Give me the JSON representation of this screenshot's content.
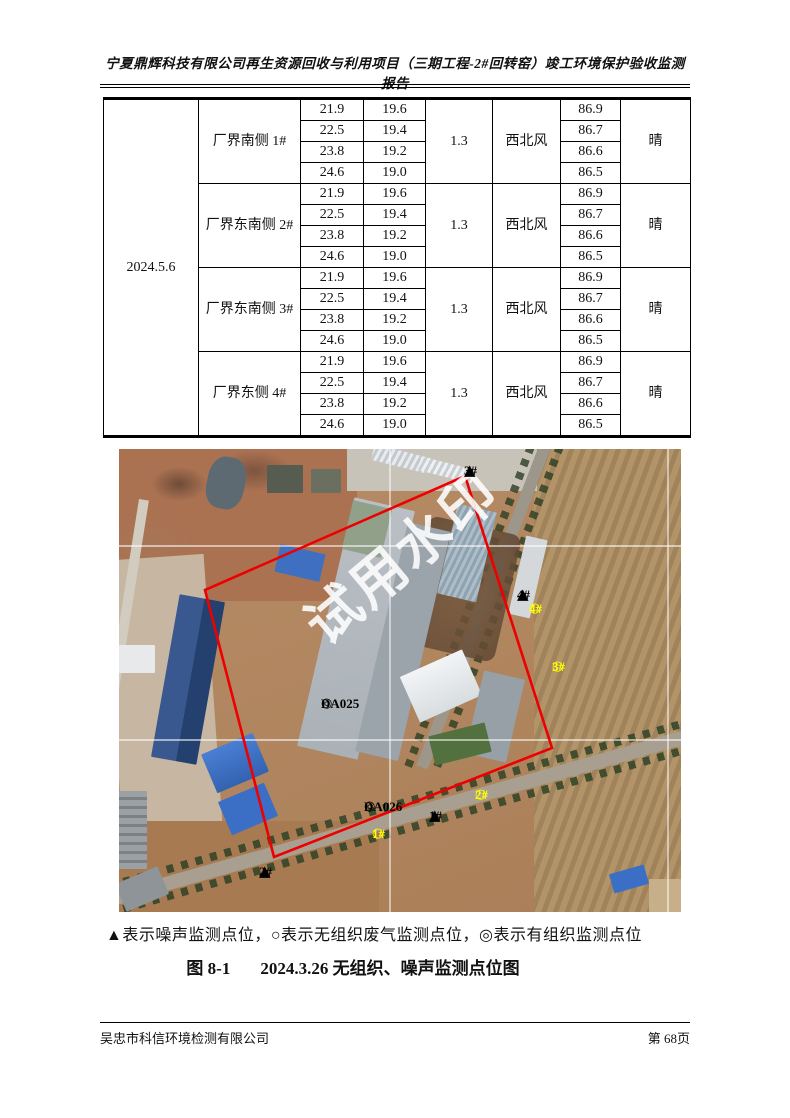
{
  "header": {
    "title": "宁夏鼎辉科技有限公司再生资源回收与利用项目（三期工程-2#回转窑）竣工环境保护验收监测报告"
  },
  "table": {
    "date": "2024.5.6",
    "groups": [
      {
        "location": "厂界南侧 1#",
        "values1": [
          "21.9",
          "22.5",
          "23.8",
          "24.6"
        ],
        "values2": [
          "19.6",
          "19.4",
          "19.2",
          "19.0"
        ],
        "speed": "1.3",
        "wind": "西北风",
        "values3": [
          "86.9",
          "86.7",
          "86.6",
          "86.5"
        ],
        "weather": "晴"
      },
      {
        "location": "厂界东南侧 2#",
        "values1": [
          "21.9",
          "22.5",
          "23.8",
          "24.6"
        ],
        "values2": [
          "19.6",
          "19.4",
          "19.2",
          "19.0"
        ],
        "speed": "1.3",
        "wind": "西北风",
        "values3": [
          "86.9",
          "86.7",
          "86.6",
          "86.5"
        ],
        "weather": "晴"
      },
      {
        "location": "厂界东南侧 3#",
        "values1": [
          "21.9",
          "22.5",
          "23.8",
          "24.6"
        ],
        "values2": [
          "19.6",
          "19.4",
          "19.2",
          "19.0"
        ],
        "speed": "1.3",
        "wind": "西北风",
        "values3": [
          "86.9",
          "86.7",
          "86.6",
          "86.5"
        ],
        "weather": "晴"
      },
      {
        "location": "厂界东侧 4#",
        "values1": [
          "21.9",
          "22.5",
          "23.8",
          "24.6"
        ],
        "values2": [
          "19.6",
          "19.4",
          "19.2",
          "19.0"
        ],
        "speed": "1.3",
        "wind": "西北风",
        "values3": [
          "86.9",
          "86.7",
          "86.6",
          "86.5"
        ],
        "weather": "晴"
      }
    ]
  },
  "map": {
    "watermark": "试用水印",
    "colors": {
      "boundary_red": "#ee0000",
      "marker_yellow": "#ffff00",
      "marker_black": "#000000"
    },
    "markers": {
      "n3": {
        "type": "triangle",
        "symbol": "▲",
        "label": "3#"
      },
      "n4": {
        "type": "triangle",
        "symbol": "▲",
        "label": "4#"
      },
      "g4": {
        "type": "circle",
        "symbol": "○",
        "label": "4#"
      },
      "g3": {
        "type": "circle",
        "symbol": "○",
        "label": "3#"
      },
      "da025": {
        "type": "double-circle",
        "symbol": "◎",
        "label": "DA025"
      },
      "da026": {
        "type": "double-circle",
        "symbol": "◎",
        "label": "DA026"
      },
      "n1": {
        "type": "triangle",
        "symbol": "▲",
        "label": "1#"
      },
      "g1": {
        "type": "circle",
        "symbol": "○",
        "label": "1#"
      },
      "g2": {
        "type": "circle",
        "symbol": "○",
        "label": "2#"
      },
      "n2": {
        "type": "triangle",
        "symbol": "▲",
        "label": "2#"
      }
    }
  },
  "legend": {
    "text": "▲表示噪声监测点位，○表示无组织废气监测点位，◎表示有组织监测点位"
  },
  "caption": {
    "figure_no": "图 8-1",
    "title": "2024.3.26 无组织、噪声监测点位图"
  },
  "footer": {
    "company": "吴忠市科信环境检测有限公司",
    "page": "第 68页"
  }
}
